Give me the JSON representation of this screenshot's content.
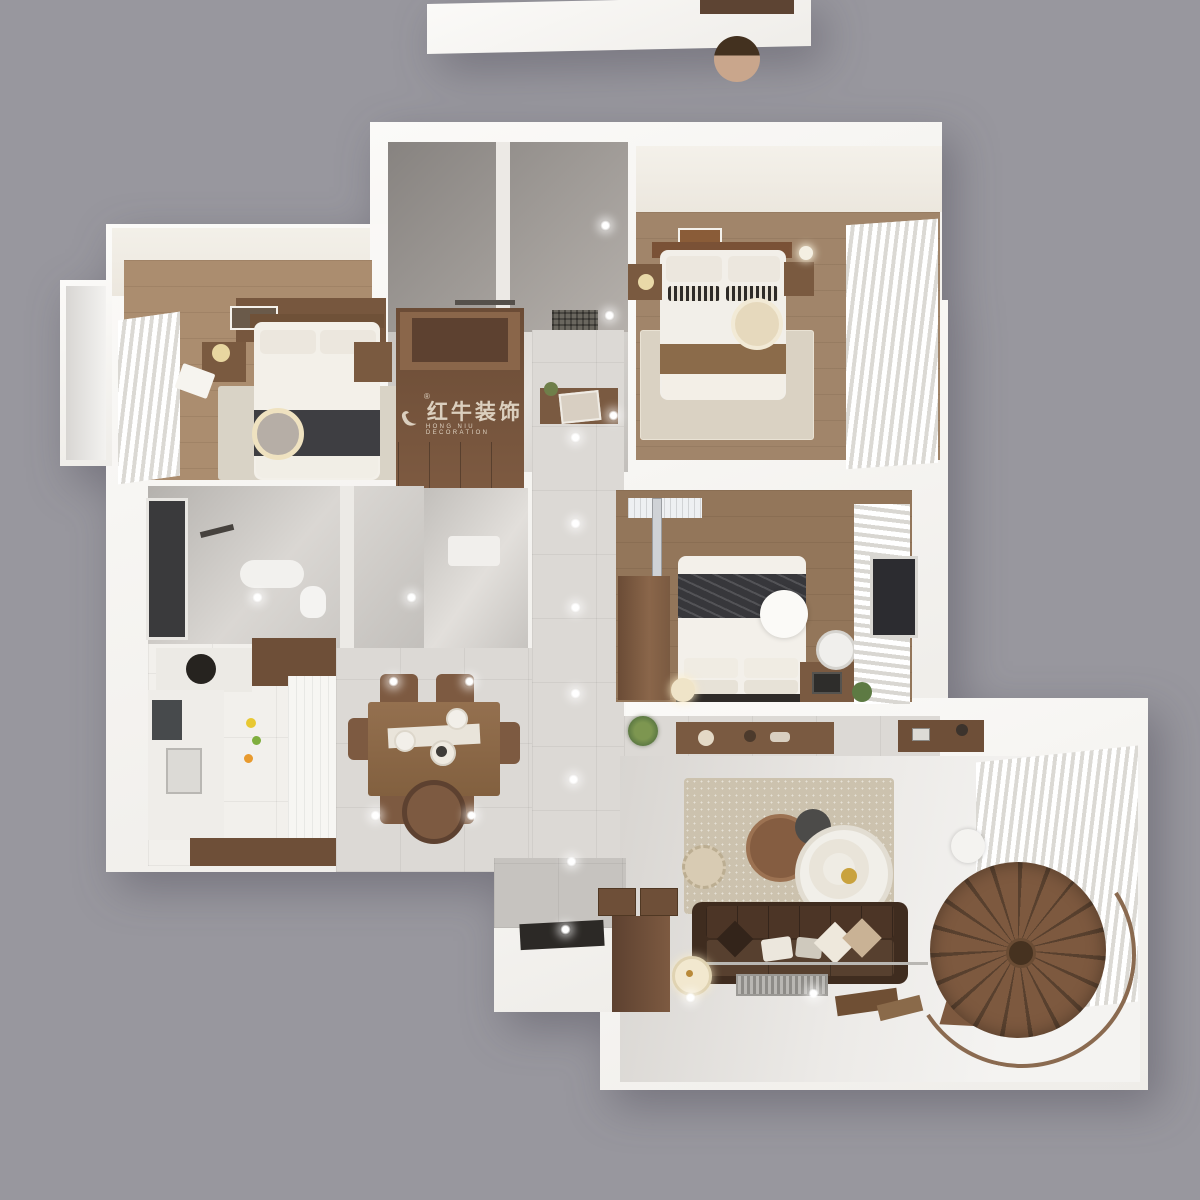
{
  "scene": {
    "background_color": "#98979e",
    "render_style": "top-down 3D apartment floor plan"
  },
  "watermark": {
    "logo_icon": "bull-swoosh-icon",
    "registered": "®",
    "brand_cn": "红牛装饰",
    "brand_en": "HONG NIU DECORATION",
    "color": "#e4daca"
  },
  "palette": {
    "background": "#98979e",
    "wall_white": "#f7f5f2",
    "ceiling_cream": "#f1ede6",
    "wood_floor_warm": "#a8896b",
    "wood_floor_dark": "#93765a",
    "cabinet_wood": "#7a5a41",
    "dark_wood": "#5d4130",
    "marble_tile": "#dcd9d5",
    "glass_gray": "#b9b4b0",
    "rug_beige": "#ccc2ae",
    "rug_light": "#d9d2c5",
    "sofa_brown": "#4c3526",
    "throw_charcoal": "#3c3c40",
    "accent_cream": "#efe2c0"
  },
  "rooms": [
    {
      "name": "second-bedroom"
    },
    {
      "name": "master-bedroom"
    },
    {
      "name": "utility-bathroom"
    },
    {
      "name": "bathroom"
    },
    {
      "name": "kitchen"
    },
    {
      "name": "dining-area"
    },
    {
      "name": "corridor"
    },
    {
      "name": "third-bedroom"
    },
    {
      "name": "living-room"
    },
    {
      "name": "entry"
    },
    {
      "name": "bay-window"
    },
    {
      "name": "spiral-staircase"
    }
  ]
}
